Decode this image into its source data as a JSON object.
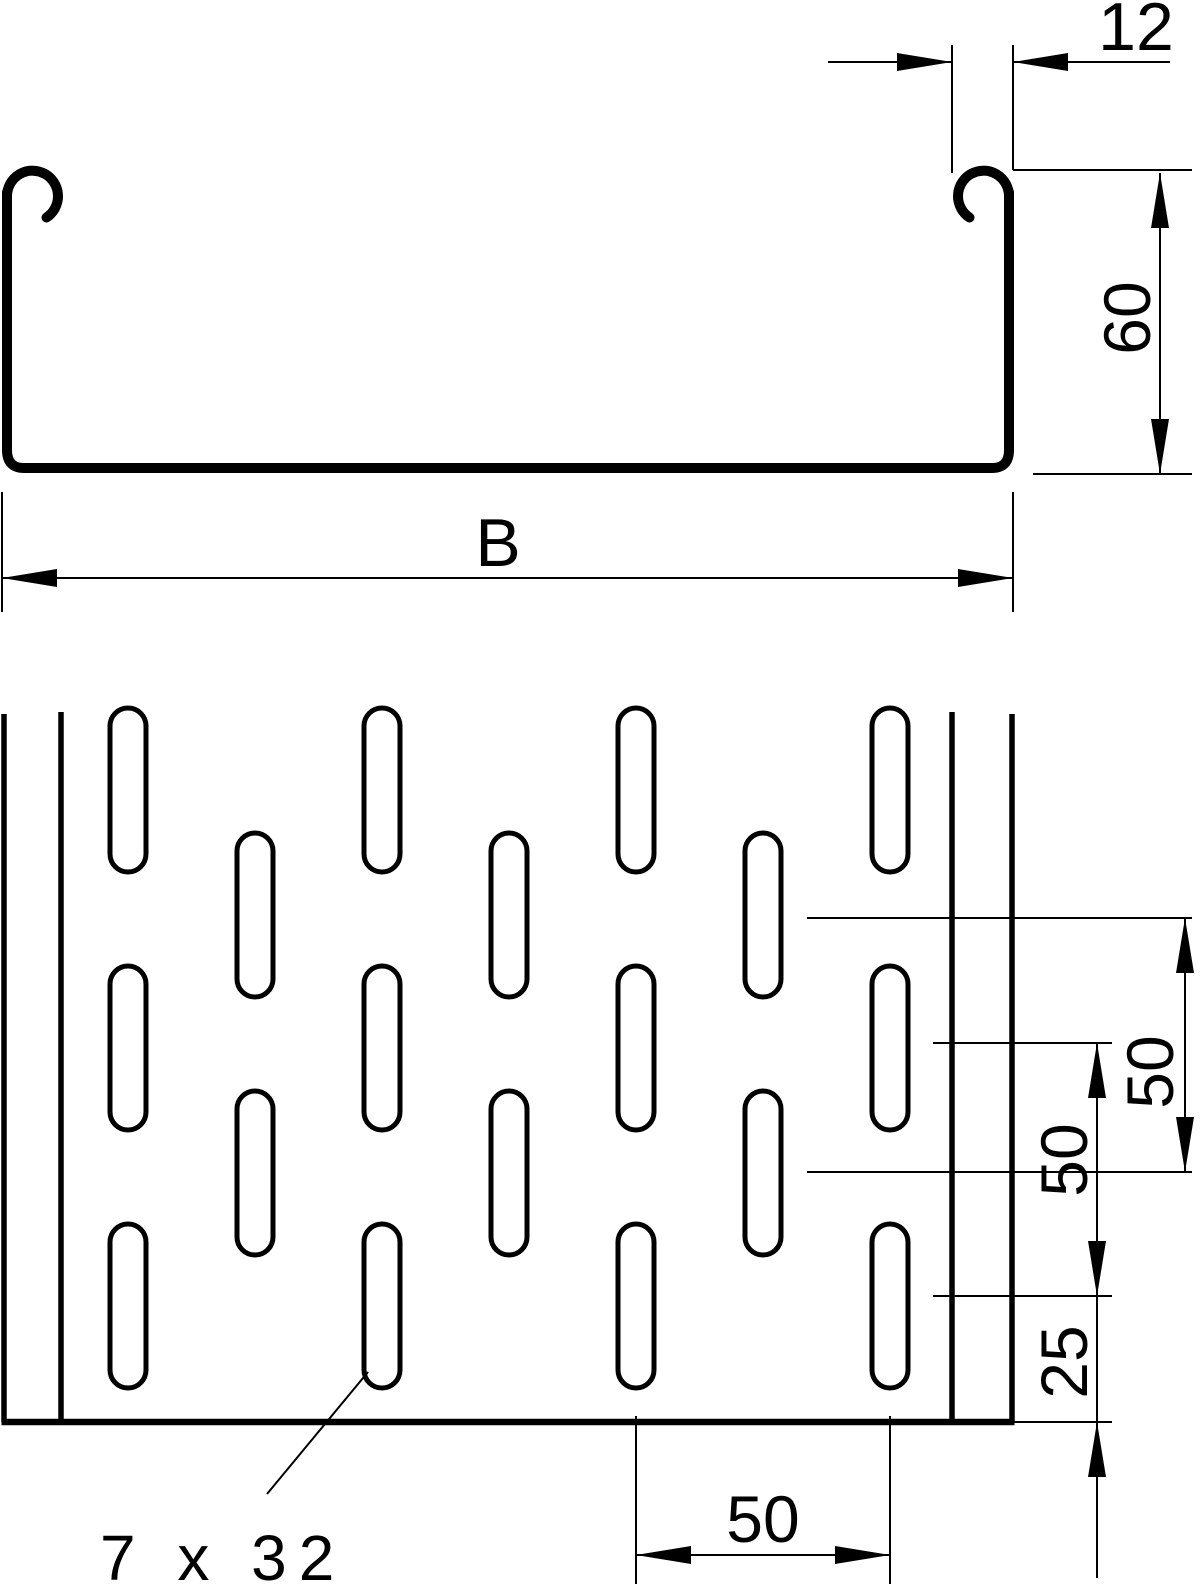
{
  "drawing": {
    "view_names": {
      "top": "cross-section of cable tray profile",
      "bottom": "plan view of perforated tray base"
    },
    "labels": {
      "lip_width": "12",
      "height": "60",
      "width": "B",
      "row_pitch_outer": "50",
      "row_pitch_inner": "50",
      "end_margin": "25",
      "column_pitch": "50",
      "perforation": "7 x 32"
    },
    "geometry_mm": {
      "lip_width": 12,
      "side_height": 60,
      "overall_width_symbol": "B",
      "slot_width": 7,
      "slot_length": 32,
      "slot_row_pitch": 50,
      "slot_column_pitch": 50,
      "slot_end_margin": 25
    },
    "plan_grid": {
      "slot_w": 36,
      "slot_h": 164,
      "rx": 18,
      "stroke_w": 5,
      "tall_col_x": [
        110,
        364,
        618,
        872
      ],
      "tall_row_y": [
        708,
        966,
        1224
      ],
      "offset_col_x": [
        237,
        491,
        745
      ],
      "offset_row_y": [
        833,
        1091
      ]
    },
    "colors": {
      "ink": "#000000",
      "paper": "#ffffff"
    }
  }
}
